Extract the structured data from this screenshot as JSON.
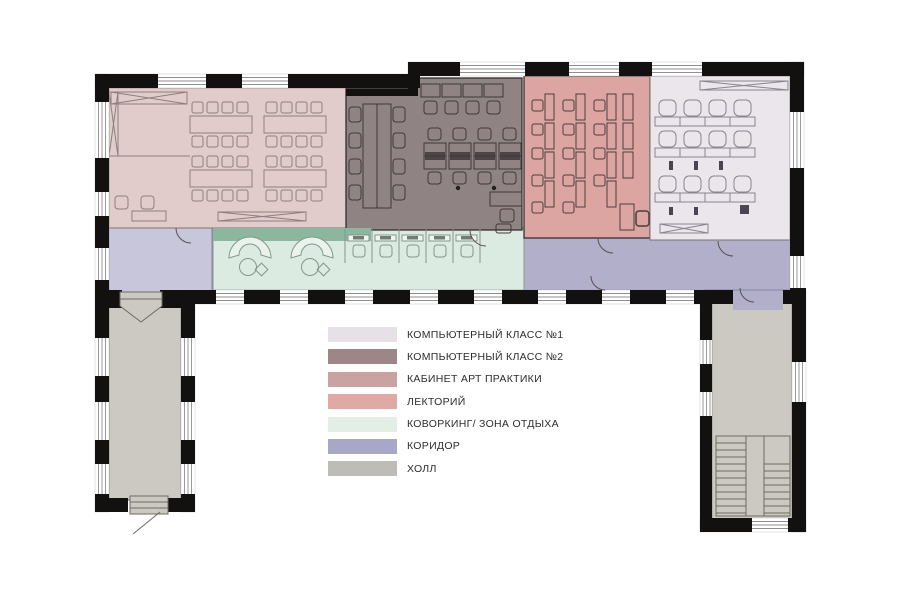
{
  "page": {
    "background": "#ffffff"
  },
  "plan": {
    "palette": {
      "wall": "#131010",
      "window_line": "#8f8f8f",
      "green_accent": "#8db69f"
    },
    "rooms": {
      "art_practice": {
        "color": "#e1cccb"
      },
      "computer_class_2": {
        "color": "#8f8384"
      },
      "lectorium": {
        "color": "#dda5a2"
      },
      "computer_class_1": {
        "color": "#eae6ec"
      },
      "coworking": {
        "color": "#dcebe2"
      },
      "coworking_accent": {
        "color": "#8db69f"
      },
      "corridor_left": {
        "color": "#c8c6db"
      },
      "corridor_right": {
        "color": "#b1afca"
      },
      "hall": {
        "color": "#cbc9c1"
      }
    }
  },
  "legend": {
    "items": [
      {
        "label": "КОМПЬЮТЕРНЫЙ КЛАСС №1",
        "color": "#e5e1e7"
      },
      {
        "label": "КОМПЬЮТЕРНЫЙ КЛАСС №2",
        "color": "#9c8688"
      },
      {
        "label": "КАБИНЕТ АРТ ПРАКТИКИ",
        "color": "#c9a2a2"
      },
      {
        "label": "ЛЕКТОРИЙ",
        "color": "#dfa9a6"
      },
      {
        "label": "КОВОРКИНГ/ ЗОНА ОТДЫХА",
        "color": "#e3eee7"
      },
      {
        "label": "КОРИДОР",
        "color": "#a9a7c7"
      },
      {
        "label": "ХОЛЛ",
        "color": "#bebcb7"
      }
    ]
  }
}
